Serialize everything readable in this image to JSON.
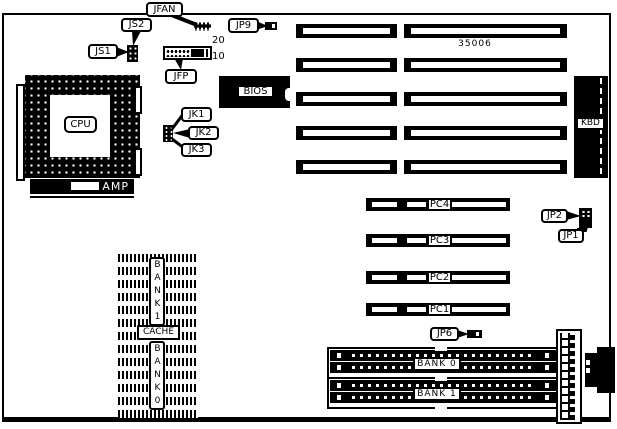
{
  "board": {
    "number": "35006",
    "ink": "#000000",
    "paper": "#ffffff"
  },
  "labels": {
    "jfan": "JFAN",
    "js2": "JS2",
    "js1": "JS1",
    "jp9": "JP9",
    "jfp": "JFP",
    "jfp_pin_top": "20",
    "jfp_pin_bottom": "10",
    "bios": "BIOS",
    "cpu": "CPU",
    "amp": "AMP",
    "jk1": "JK1",
    "jk2": "JK2",
    "jk3": "JK3",
    "kbd": "KBD",
    "jp2": "JP2",
    "jp1": "JP1",
    "jp6": "JP6",
    "cache": "CACHE",
    "cache_bank1": "BANK1",
    "cache_bank0": "BANK0",
    "simm_bank0": "BANK 0",
    "simm_bank1": "BANK 1"
  },
  "pci_slots": [
    "PC4",
    "PC3",
    "PC2",
    "PC1"
  ]
}
